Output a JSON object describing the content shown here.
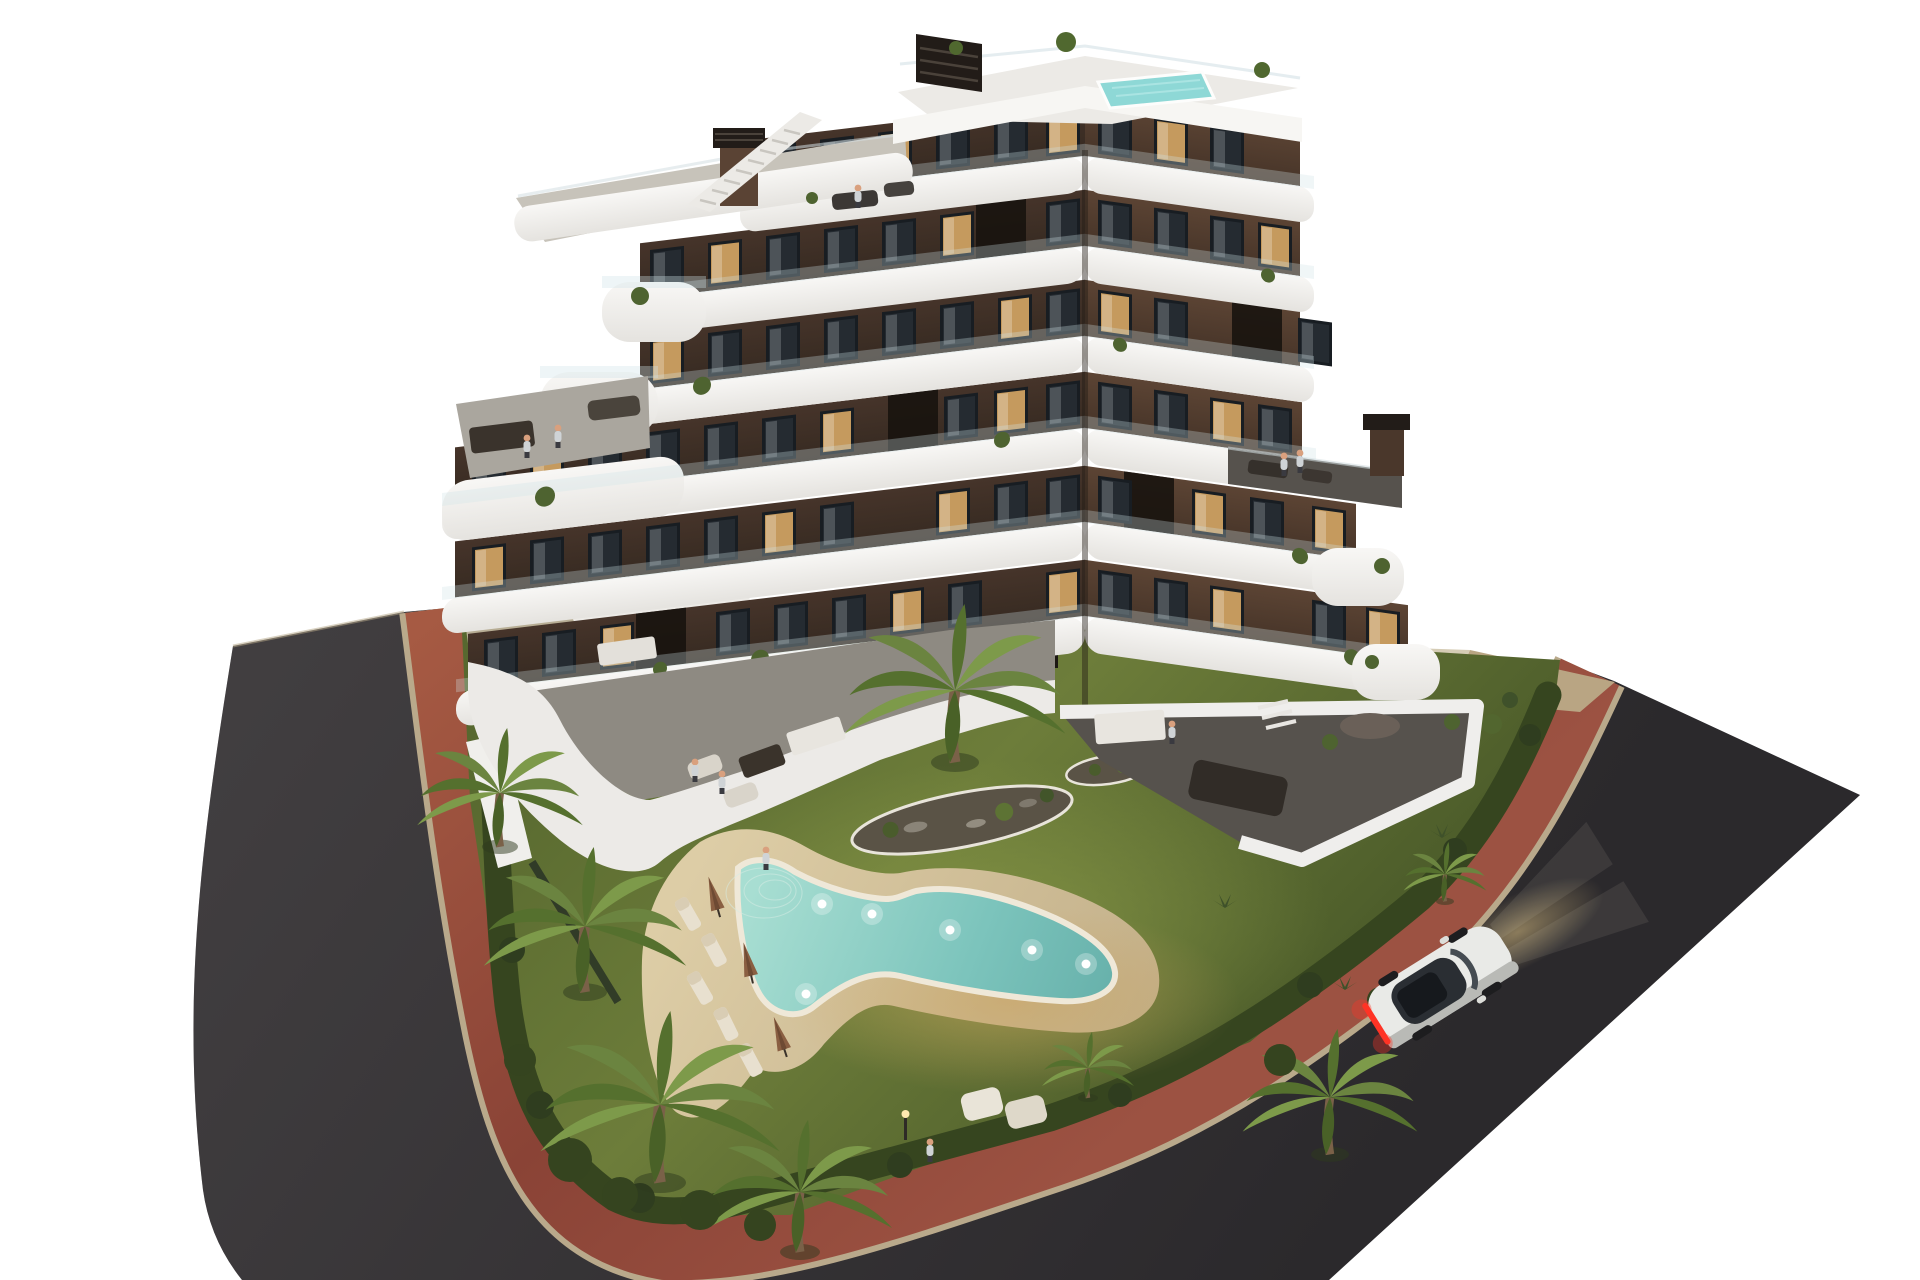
{
  "scene": {
    "type": "3d-architectural-rendering",
    "view": "aerial-dusk",
    "background": "#ffffff",
    "subject": "modern-apartment-residence-with-garden-pool-and-street"
  },
  "colors": {
    "background": "#ffffff",
    "asphalt_light": "#413e40",
    "asphalt_dark": "#2b292c",
    "path_light": "#a65a43",
    "path_mid": "#8a4336",
    "path_dark": "#9c5242",
    "curb": "#b9a98b",
    "grass_light": "#6d7d3a",
    "grass_mid": "#57682f",
    "grass_dark": "#4e5e2b",
    "hedge": "#36451f",
    "palm_light": "#7d9a4a",
    "palm_mid": "#6b8440",
    "palm_dark": "#55702e",
    "trunk": "#7a6148",
    "pool_light": "#a8ded2",
    "pool_mid": "#7cc4bc",
    "pool_deep": "#66b0aa",
    "rooftop_pool": "#8ed8d6",
    "sand_light": "#ddcda6",
    "sand_dark": "#c3b08a",
    "facade_left_light": "#46342a",
    "facade_left_dark": "#362a21",
    "facade_right_light": "#5c4434",
    "facade_right_dark": "#463428",
    "slab_light": "#f8f7f5",
    "slab_dark": "#e5e3df",
    "window": "#252b31",
    "window_lit": "#d8a965",
    "glass": "#cfe3e8",
    "concrete": "#aaa69e",
    "terrace_floor": "#56524d",
    "chimney": "#221c18",
    "car_body": "#e9eae7",
    "car_glass": "#2a2e33",
    "taillight": "#ff3325",
    "headlight_glow": "#9c8a64"
  },
  "building": {
    "residential_floors": 6,
    "wings": 2,
    "balcony_style": "curved-white-bands",
    "rooftop": {
      "penthouse": true,
      "plunge_pool": true,
      "staircase": true,
      "chimneys": 2,
      "roof_terraces": 2
    }
  },
  "amenities": {
    "swimming_pool_shape": "freeform-boomerang",
    "pool_underwater_lights": 6,
    "sun_loungers": 5,
    "parasols": 3,
    "poolside_sofas": 2,
    "planting_beds": 2
  },
  "vegetation": {
    "large_palms": 7,
    "small_palms": 2,
    "perimeter_hedge": true,
    "shrubs": true
  },
  "street": {
    "asphalt_road": true,
    "brick_sidewalk": true,
    "wraps_corner": true
  },
  "vehicles": {
    "count": 1,
    "type": "coupe",
    "color": "white",
    "taillights_on": true,
    "headlights_on": true
  },
  "people_visible": 10
}
